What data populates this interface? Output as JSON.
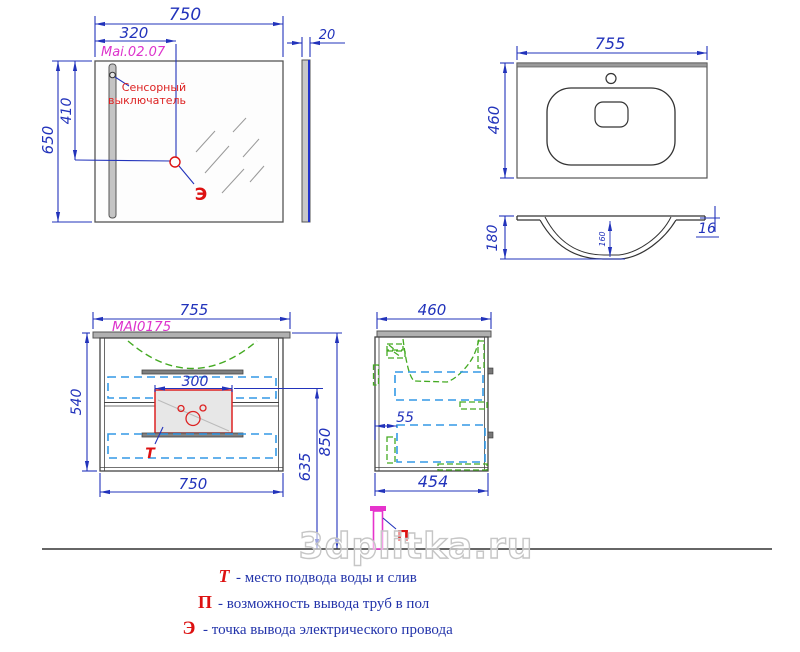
{
  "watermark": {
    "text": "3dplitka.ru"
  },
  "mirror_front": {
    "dim_width": "750",
    "dim_switch_offset": "320",
    "model": "Mai.02.07",
    "dim_height": "650",
    "dim_outlet_height": "410",
    "switch_note_line1": "Сенсорный",
    "switch_note_line2": "выключатель",
    "outlet_marker": "Э"
  },
  "mirror_side": {
    "dim_thickness": "20"
  },
  "sink_top": {
    "dim_width": "755",
    "dim_depth": "460"
  },
  "sink_profile": {
    "dim_height": "180",
    "dim_bowl_depth": "160",
    "dim_edge_thickness": "16"
  },
  "cabinet_front": {
    "dim_top_width": "755",
    "model": "MAI0175",
    "dim_height": "540",
    "dim_siphon_width": "300",
    "dim_bottom_width": "750",
    "dim_total_height": "850",
    "dim_drain_height": "635",
    "water_marker": "Т"
  },
  "cabinet_side": {
    "dim_top_depth": "460",
    "dim_back_gap": "55",
    "dim_bottom_depth": "454"
  },
  "floor": {
    "pipe_marker": "П"
  },
  "legend": {
    "rows": [
      {
        "key": "Т",
        "text": "- место подвода воды и слив"
      },
      {
        "key": "П",
        "text": "- возможность вывода труб в пол"
      },
      {
        "key": "Э",
        "text": "- точка вывода электрического провода"
      }
    ]
  },
  "colors": {
    "dimension_blue": "#2233bb",
    "model_magenta": "#dd33cc",
    "annotation_red": "#dd1111",
    "hidden_drawer_cyan": "#3399e6",
    "hidden_basin_green": "#44aa22",
    "outline_gray": "#444444",
    "watermark_gray": "#c6c6c6"
  }
}
